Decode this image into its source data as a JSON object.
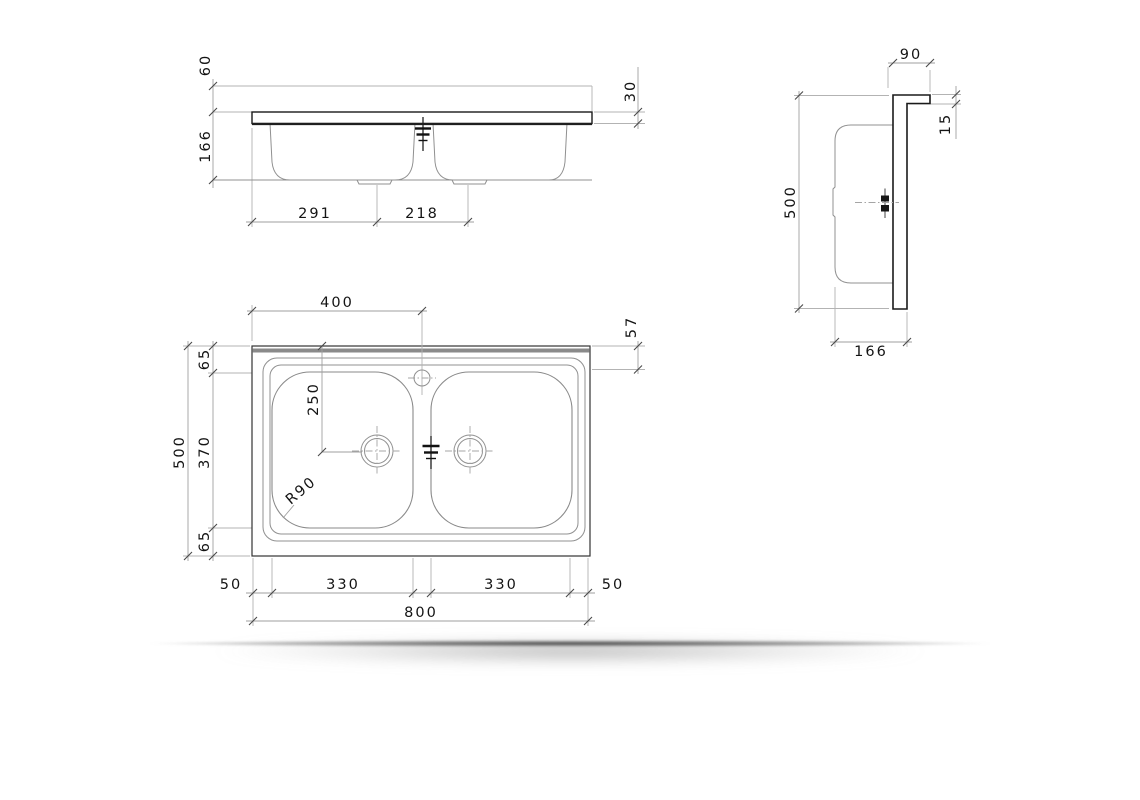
{
  "drawing": {
    "description": "Sink technical drawing, three orthographic views",
    "colors": {
      "line_dark": "#1f1f1f",
      "line_light": "#9a9a9a",
      "band_gray": "#8a8a8a",
      "background": "#ffffff"
    },
    "front_view": {
      "dims": {
        "backsplash_height": "60",
        "bowl_depth": "166",
        "worktop_thickness": "30",
        "left_to_drain1": "291",
        "drain1_to_drain2": "218"
      }
    },
    "side_view": {
      "dims": {
        "backsplash_depth": "90",
        "backsplash_thickness": "15",
        "overall_depth": "500",
        "bowl_section_depth": "166"
      }
    },
    "plan_view": {
      "dims": {
        "faucet_from_left": "400",
        "faucet_from_back": "57",
        "back_margin": "65",
        "bowl_width": "370",
        "front_margin": "65",
        "overall_depth": "500",
        "drain_from_back": "250",
        "corner_radius": "R90",
        "left_margin": "50",
        "bowl1_length": "330",
        "bowl2_length": "330",
        "right_margin": "50",
        "overall_length": "800"
      }
    }
  }
}
